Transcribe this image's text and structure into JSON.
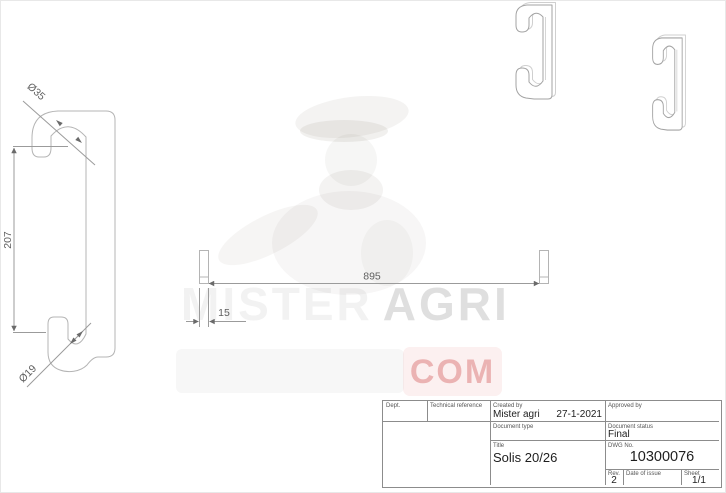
{
  "watermark": {
    "word1": "MISTER",
    "word2": "AGRI",
    "suffix": "COM"
  },
  "views": {
    "side": {
      "top_hook_diameter": "Ø35",
      "height": "207",
      "bottom_hook_diameter": "Ø19"
    },
    "bar": {
      "length": "895",
      "thickness": "15"
    }
  },
  "title_block": {
    "dept_label": "Dept.",
    "technical_reference_label": "Technical reference",
    "created_by_label": "Created by",
    "created_by": "Mister agri",
    "created_date": "27-1-2021",
    "approved_by_label": "Approved by",
    "document_type_label": "Document type",
    "document_status_label": "Document status",
    "document_status": "Final",
    "title_label": "Title",
    "title": "Solis 20/26",
    "dwg_no_label": "DWG No.",
    "dwg_no": "10300076",
    "rev_label": "Rev.",
    "rev": "2",
    "date_of_issue_label": "Date of issue",
    "sheet_label": "Sheet",
    "sheet": "1/1"
  },
  "colors": {
    "drawing_line": "#b4b4b4",
    "dimension_text": "#5f5f5f",
    "title_block_line": "#8c8c8c",
    "watermark_gray": "#9a9a9a",
    "watermark_red": "#d98080"
  }
}
